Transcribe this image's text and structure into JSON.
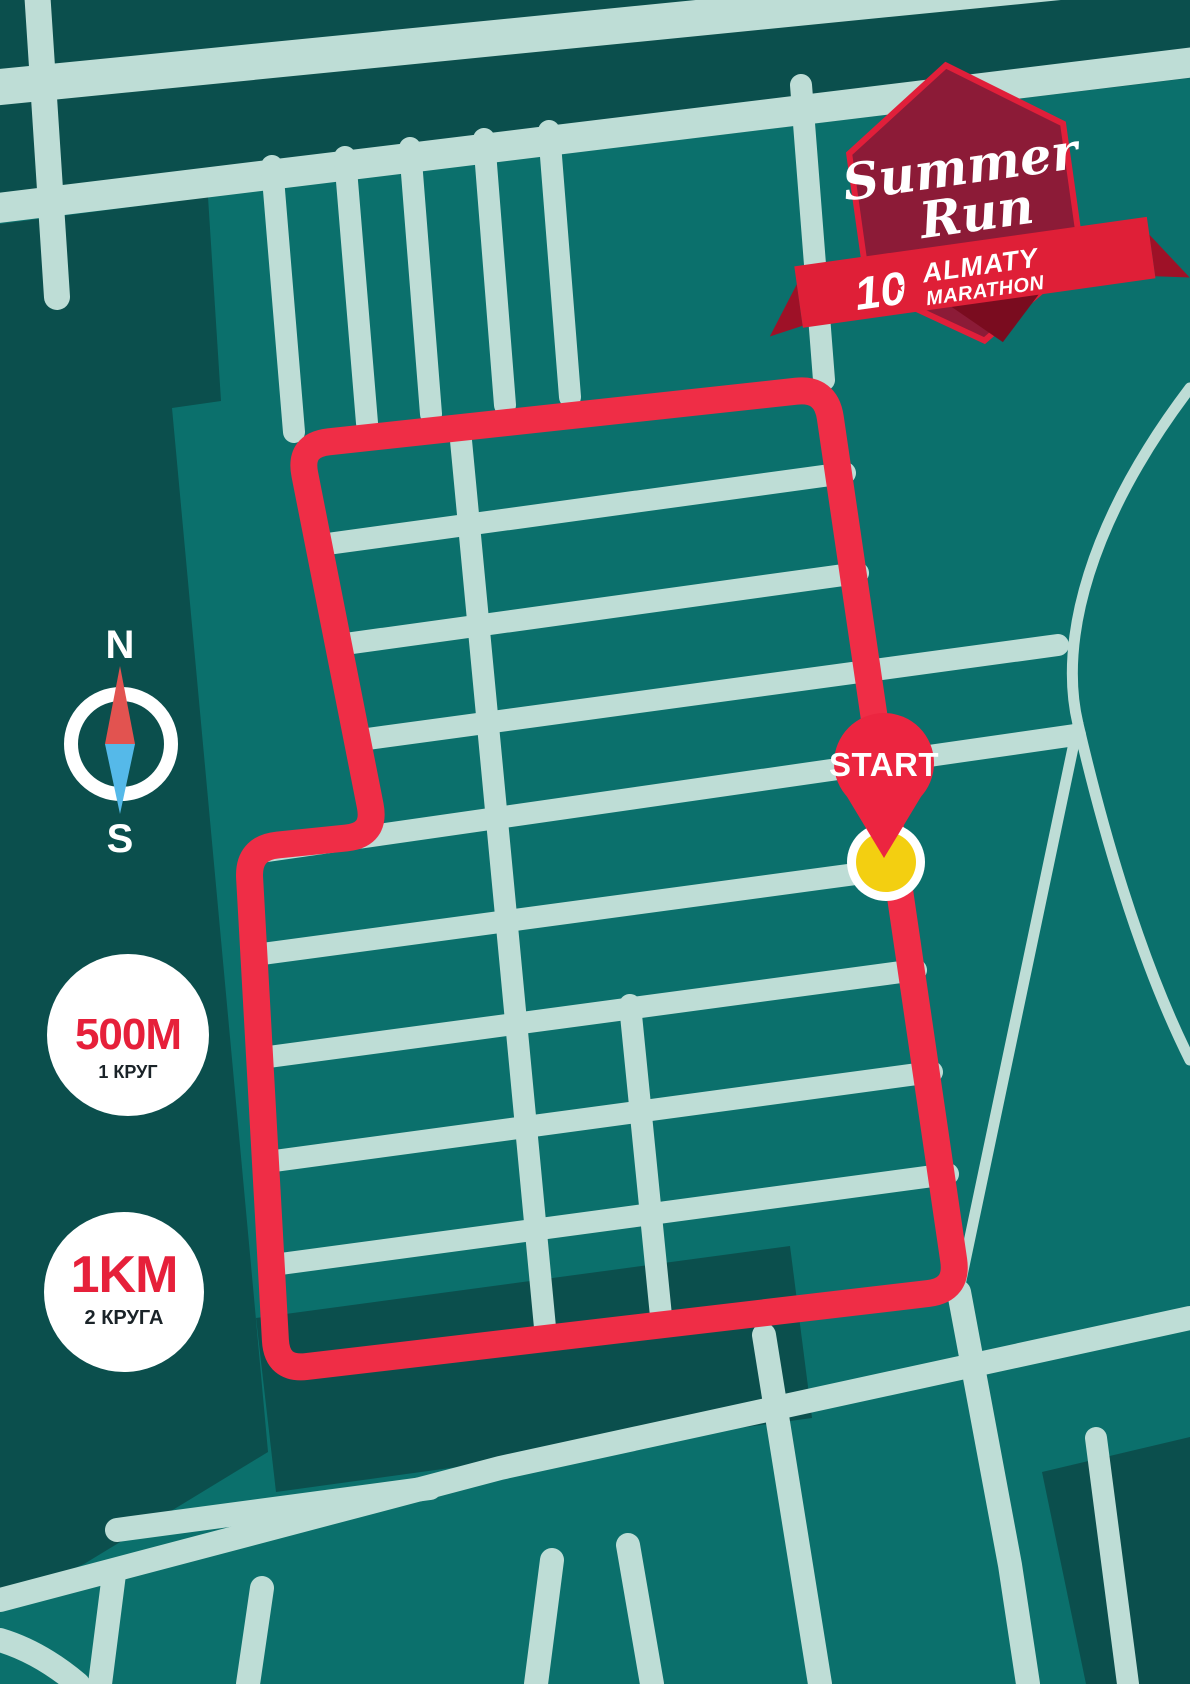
{
  "poster": {
    "event_logo": {
      "title_line1": "Summer",
      "title_line2": "Run",
      "anniversary_number": "10",
      "brand_line1": "ALMATY",
      "brand_line2": "MARATHON",
      "star_icon_glyph": "★"
    },
    "compass": {
      "north_label": "N",
      "south_label": "S"
    },
    "start_marker": {
      "label": "START"
    },
    "distance_badges": [
      {
        "distance": "500M",
        "laps": "1 КРУГ"
      },
      {
        "distance": "1KM",
        "laps": "2 КРУГА"
      }
    ],
    "colors": {
      "background": "#0B706C",
      "dark_blocks": "#0B4F4D",
      "streets": "#BEDDD6",
      "route_red": "#EF2D46",
      "pin_red": "#EC2540",
      "marker_yellow": "#F3CF11",
      "compass_needle_red": "#E25350",
      "compass_needle_blue": "#55B9E9",
      "badge_text_red": "#E6203A",
      "badge_text_dark": "#1A2328",
      "logo_maroon": "#8C1B37",
      "logo_ribbon_red": "#DF1F37",
      "logo_border_red": "#E01F3A",
      "white": "#FFFFFF"
    }
  }
}
